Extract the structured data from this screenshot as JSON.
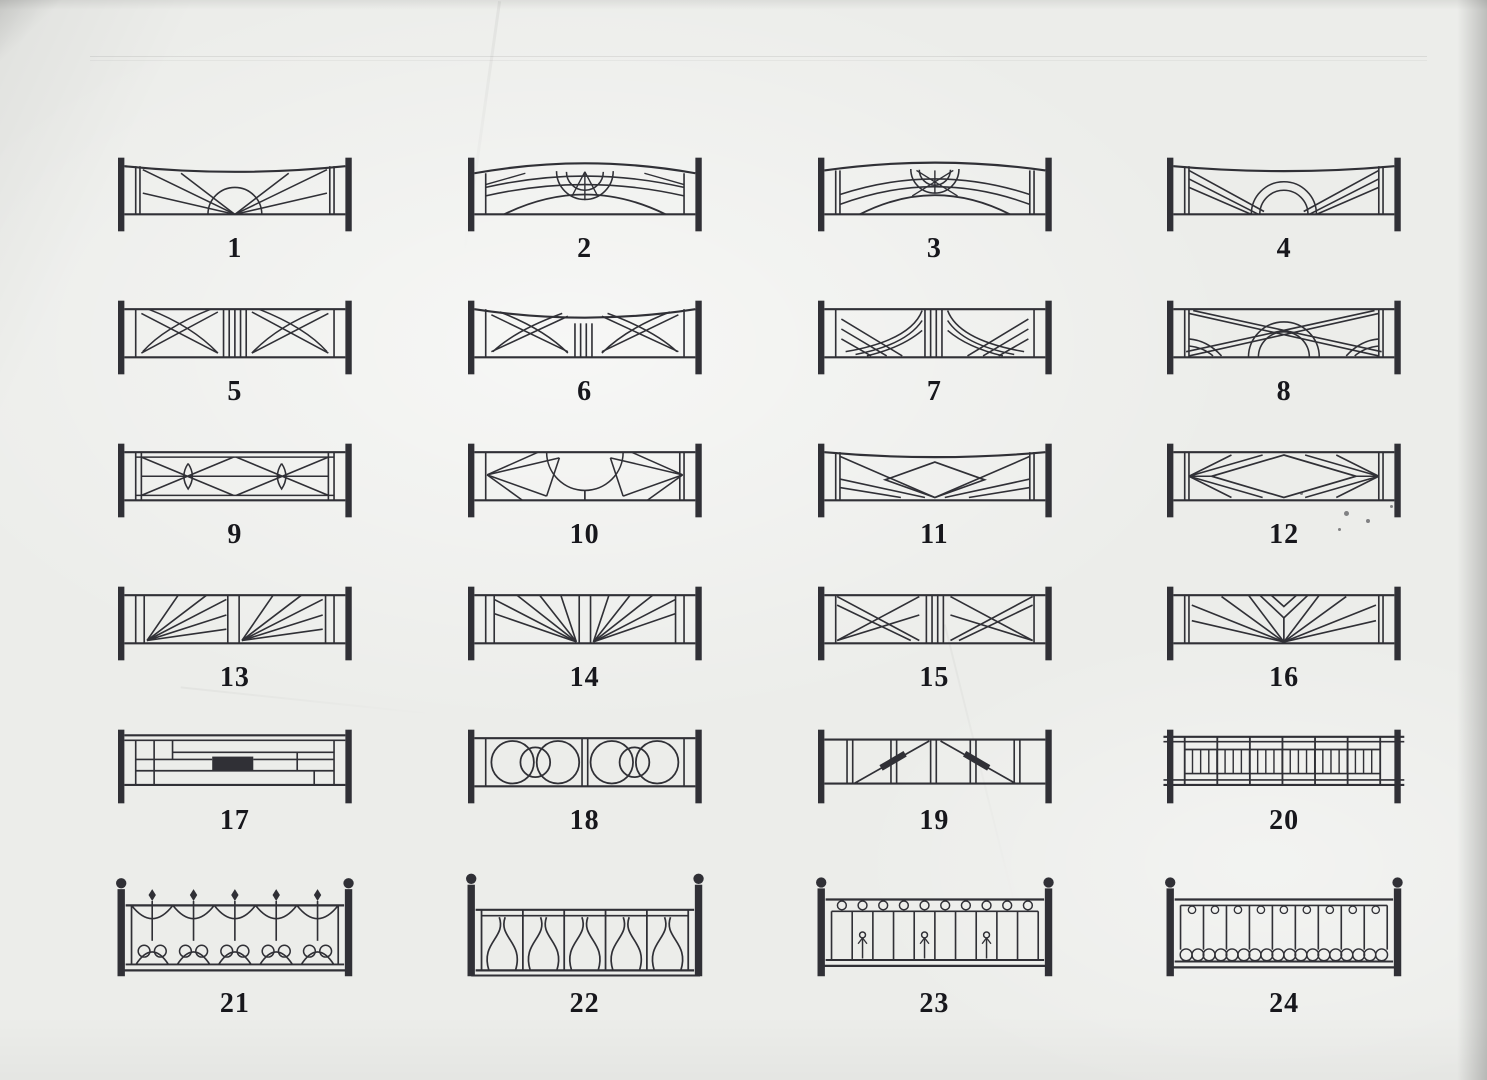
{
  "colors": {
    "ink": "#303036",
    "paper": "#ecedea"
  },
  "figures": [
    {
      "label": "1",
      "motif": "sunrise-rays-sagging-top"
    },
    {
      "label": "2",
      "motif": "triple-arch-half-sun"
    },
    {
      "label": "3",
      "motif": "crossing-arches-half-sun"
    },
    {
      "label": "4",
      "motif": "diagonal-bands-double-arc-sun"
    },
    {
      "label": "5",
      "motif": "center-bars-crossed-arcs"
    },
    {
      "label": "6",
      "motif": "sagging-top-center-bars-crossed-arcs"
    },
    {
      "label": "7",
      "motif": "nested-fountain-arcs-center-bars"
    },
    {
      "label": "8",
      "motif": "crossed-bands-double-sun"
    },
    {
      "label": "9",
      "motif": "double-x-panels-with-lenses"
    },
    {
      "label": "10",
      "motif": "hanging-dome-side-fans"
    },
    {
      "label": "11",
      "motif": "center-diamond-sagging-top"
    },
    {
      "label": "12",
      "motif": "center-diamond-side-fans"
    },
    {
      "label": "13",
      "motif": "twin-corner-sunbursts"
    },
    {
      "label": "14",
      "motif": "twin-center-sunbursts"
    },
    {
      "label": "15",
      "motif": "crossed-diagonal-panels"
    },
    {
      "label": "16",
      "motif": "branching-fan"
    },
    {
      "label": "17",
      "motif": "rectilinear-blocks-solid-center"
    },
    {
      "label": "18",
      "motif": "interlocking-rings"
    },
    {
      "label": "19",
      "motif": "barred-panels-thick-diagonal"
    },
    {
      "label": "20",
      "motif": "ladder-grid"
    },
    {
      "label": "21",
      "motif": "arched-spears-heart-scrolls"
    },
    {
      "label": "22",
      "motif": "art-nouveau-tulips"
    },
    {
      "label": "23",
      "motif": "spiral-curls-balusters"
    },
    {
      "label": "24",
      "motif": "curls-balusters-heart-scrolls"
    }
  ]
}
